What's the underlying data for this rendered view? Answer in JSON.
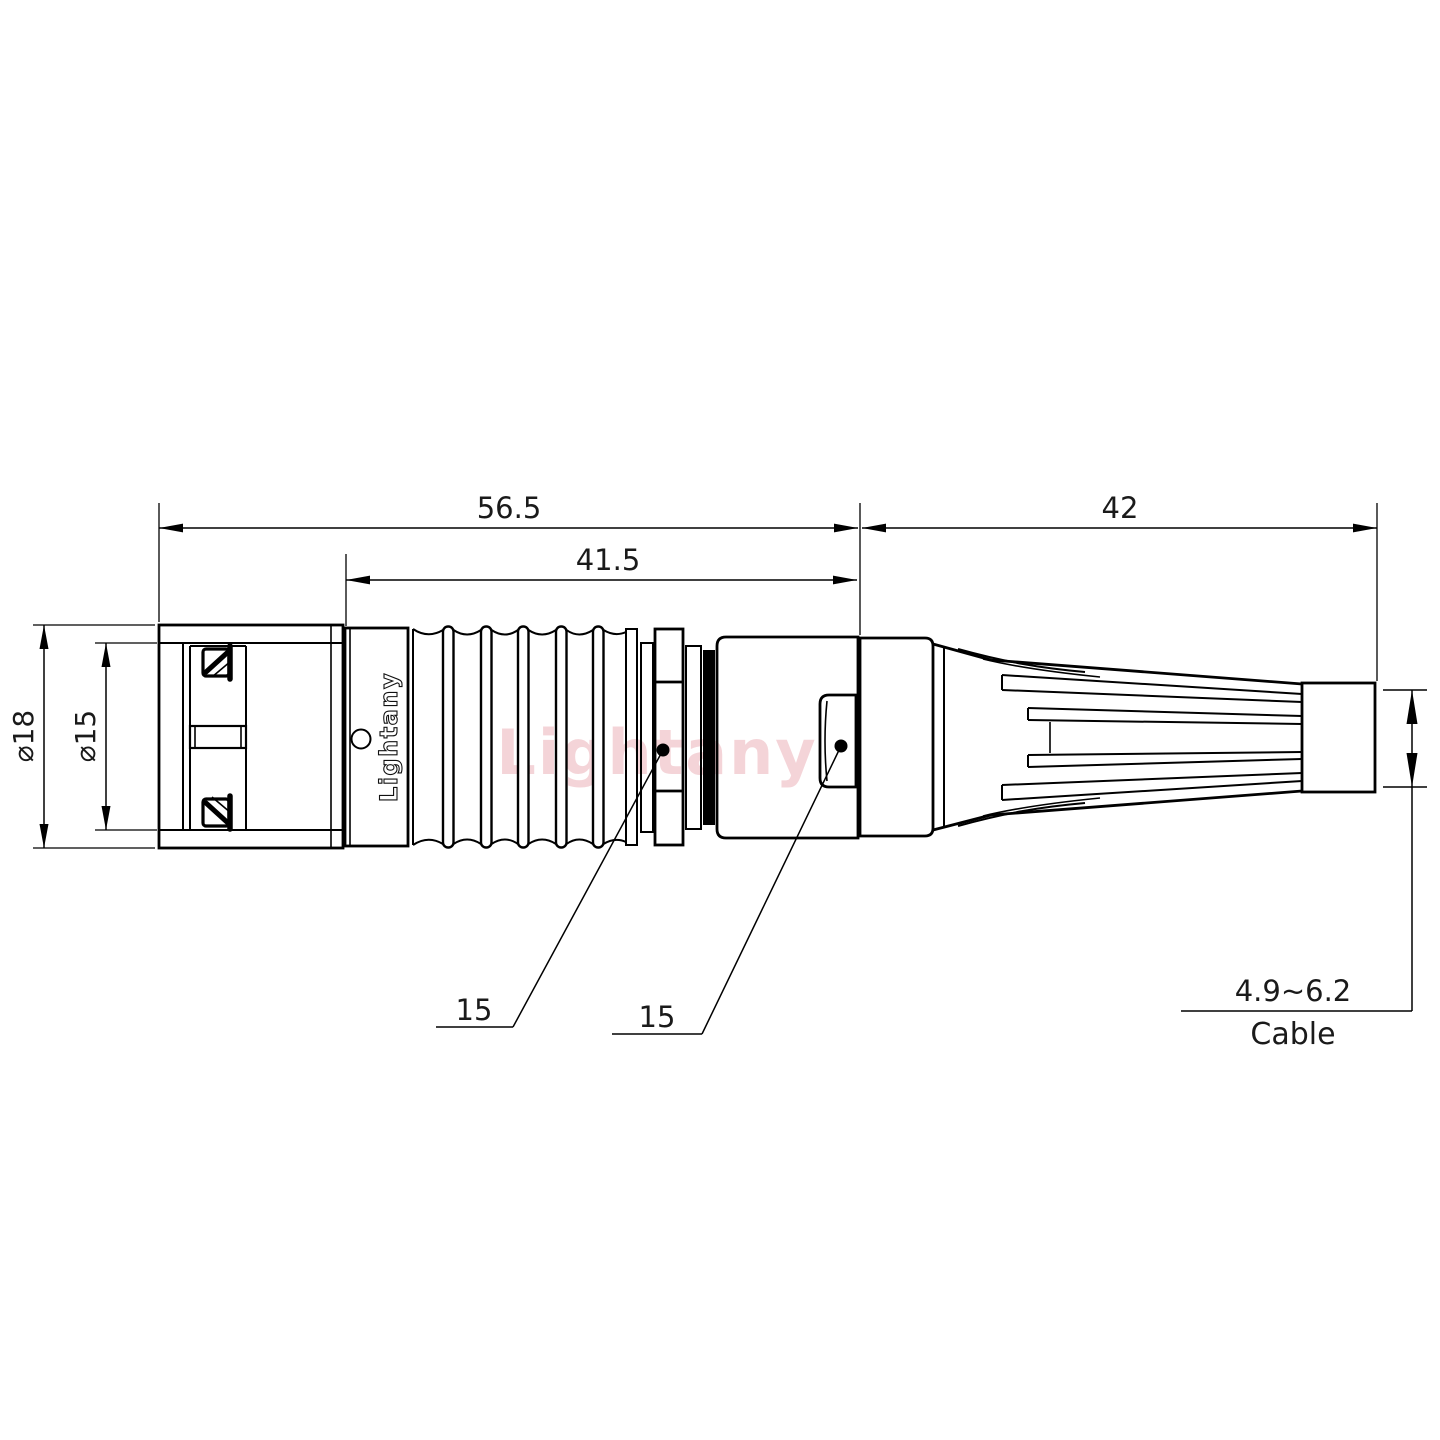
{
  "watermark": {
    "text": "Lightany",
    "color": "#e695a0"
  },
  "part": {
    "marking": "Lightany"
  },
  "dimensions": {
    "overall_length": "56.5",
    "grip_length": "41.5",
    "boot_length": "42",
    "outer_diameter": "⌀18",
    "front_diameter": "⌀15",
    "collar_ref": "15",
    "housing_ref": "15",
    "cable_range": "4.9~6.2",
    "cable_label": "Cable"
  },
  "colors": {
    "line": "#000000",
    "background": "#ffffff"
  }
}
